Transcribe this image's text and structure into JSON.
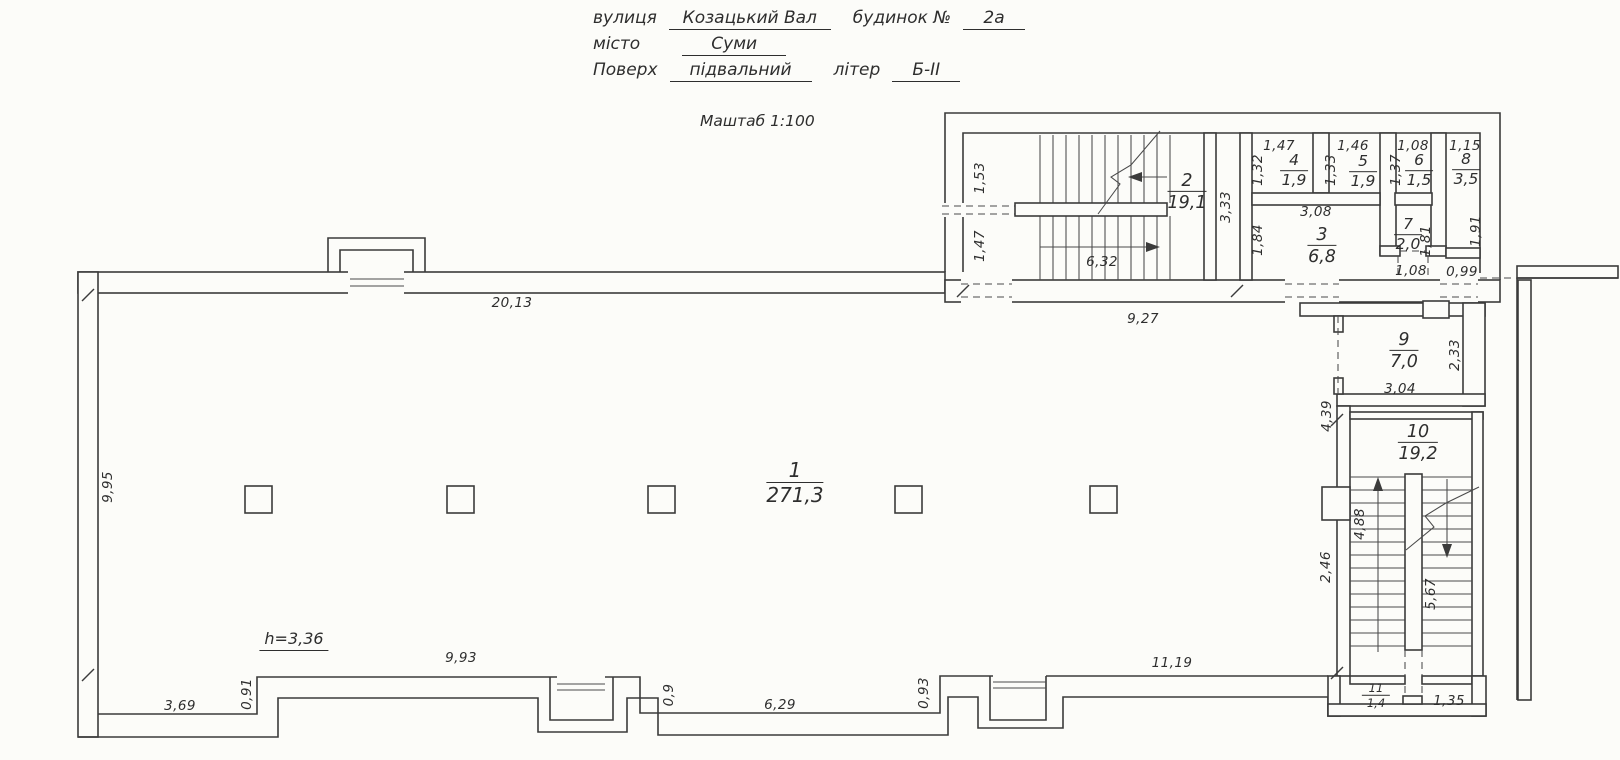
{
  "header": {
    "street_label": "вулиця",
    "street_value": "Козацький Вал",
    "building_label": "будинок №",
    "building_value": "2а",
    "city_label": "місто",
    "city_value": "Суми",
    "floor_label": "Поверх",
    "floor_value": "підвальний",
    "letter_label": "літер",
    "letter_value": "Б-II",
    "scale": "Маштаб 1:100"
  },
  "plan": {
    "height_note": "h=3,36",
    "rooms": [
      {
        "number": "1",
        "area": "271,3",
        "x": 795,
        "y": 483,
        "size": "large"
      },
      {
        "number": "2",
        "area": "19,1",
        "x": 1187,
        "y": 192,
        "size": "big"
      },
      {
        "number": "3",
        "area": "6,8",
        "x": 1322,
        "y": 246,
        "size": "big"
      },
      {
        "number": "4",
        "area": "1,9",
        "x": 1294,
        "y": 171,
        "size": ""
      },
      {
        "number": "5",
        "area": "1,9",
        "x": 1363,
        "y": 172,
        "size": ""
      },
      {
        "number": "6",
        "area": "1,5",
        "x": 1419,
        "y": 171,
        "size": ""
      },
      {
        "number": "7",
        "area": "2,0",
        "x": 1408,
        "y": 235,
        "size": ""
      },
      {
        "number": "8",
        "area": "3,5",
        "x": 1466,
        "y": 170,
        "size": ""
      },
      {
        "number": "9",
        "area": "7,0",
        "x": 1404,
        "y": 351,
        "size": "big"
      },
      {
        "number": "10",
        "area": "19,2",
        "x": 1418,
        "y": 443,
        "size": "big"
      },
      {
        "number": "11",
        "area": "1,4",
        "x": 1376,
        "y": 696,
        "size": "small"
      }
    ],
    "dimensions": [
      {
        "t": "20,13",
        "x": 512,
        "y": 303,
        "r": 0
      },
      {
        "t": "9,27",
        "x": 1143,
        "y": 319,
        "r": 0
      },
      {
        "t": "6,32",
        "x": 1102,
        "y": 262,
        "r": 0
      },
      {
        "t": "1,53",
        "x": 980,
        "y": 178,
        "r": 1
      },
      {
        "t": "1,47",
        "x": 980,
        "y": 246,
        "r": 1
      },
      {
        "t": "3,33",
        "x": 1226,
        "y": 207,
        "r": 1
      },
      {
        "t": "1,47",
        "x": 1279,
        "y": 146,
        "r": 0
      },
      {
        "t": "1,32",
        "x": 1258,
        "y": 170,
        "r": 1
      },
      {
        "t": "1,46",
        "x": 1353,
        "y": 146,
        "r": 0
      },
      {
        "t": "1,33",
        "x": 1331,
        "y": 170,
        "r": 1
      },
      {
        "t": "1,08",
        "x": 1413,
        "y": 146,
        "r": 0
      },
      {
        "t": "1,37",
        "x": 1396,
        "y": 170,
        "r": 1
      },
      {
        "t": "1,15",
        "x": 1465,
        "y": 146,
        "r": 0
      },
      {
        "t": "1,91",
        "x": 1476,
        "y": 231,
        "r": 1
      },
      {
        "t": "3,08",
        "x": 1316,
        "y": 212,
        "r": 0
      },
      {
        "t": "1,84",
        "x": 1258,
        "y": 240,
        "r": 1
      },
      {
        "t": "1,81",
        "x": 1426,
        "y": 241,
        "r": 1
      },
      {
        "t": "1,08",
        "x": 1411,
        "y": 271,
        "r": 0
      },
      {
        "t": "0,99",
        "x": 1462,
        "y": 272,
        "r": 0
      },
      {
        "t": "9,95",
        "x": 108,
        "y": 487,
        "r": 1
      },
      {
        "t": "2,33",
        "x": 1455,
        "y": 355,
        "r": 1
      },
      {
        "t": "3,04",
        "x": 1400,
        "y": 389,
        "r": 0
      },
      {
        "t": "4,39",
        "x": 1327,
        "y": 416,
        "r": 1
      },
      {
        "t": "2,46",
        "x": 1326,
        "y": 567,
        "r": 1
      },
      {
        "t": "4,88",
        "x": 1360,
        "y": 524,
        "r": 1
      },
      {
        "t": "5,67",
        "x": 1431,
        "y": 594,
        "r": 1
      },
      {
        "t": "11,19",
        "x": 1172,
        "y": 663,
        "r": 0
      },
      {
        "t": "1,35",
        "x": 1449,
        "y": 701,
        "r": 0
      },
      {
        "t": "3,69",
        "x": 180,
        "y": 706,
        "r": 0
      },
      {
        "t": "0,91",
        "x": 247,
        "y": 694,
        "r": 1
      },
      {
        "t": "9,93",
        "x": 461,
        "y": 658,
        "r": 0
      },
      {
        "t": "0,9",
        "x": 669,
        "y": 695,
        "r": 1
      },
      {
        "t": "6,29",
        "x": 780,
        "y": 705,
        "r": 0
      },
      {
        "t": "0,93",
        "x": 924,
        "y": 693,
        "r": 1
      }
    ]
  }
}
